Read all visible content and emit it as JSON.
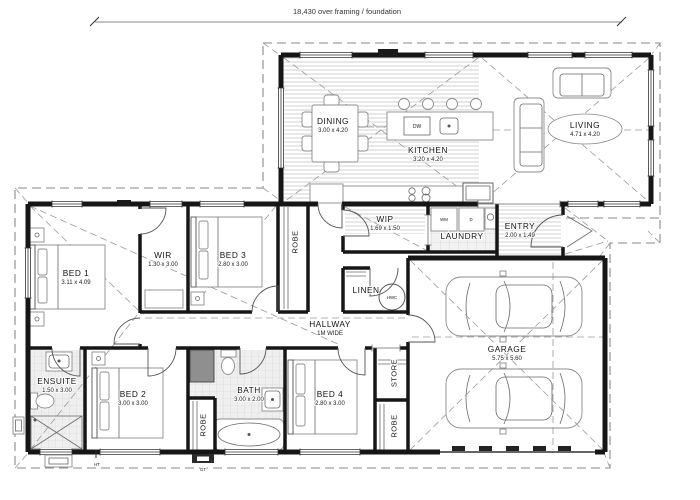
{
  "plan": {
    "dimension_note": "18,430 over framing / foundation",
    "rooms": {
      "dining": {
        "name": "DINING",
        "dims": "3.00 x 4.20"
      },
      "kitchen": {
        "name": "KITCHEN",
        "dims": "3.20 x 4.20"
      },
      "living": {
        "name": "LIVING",
        "dims": "4.71 x 4.20"
      },
      "wip": {
        "name": "WIP",
        "dims": "1.69 x 1.50"
      },
      "laundry": {
        "name": "LAUNDRY"
      },
      "entry": {
        "name": "ENTRY",
        "dims": "2.00 x 1.49"
      },
      "wir": {
        "name": "WIR",
        "dims": "1.30 x 3.00"
      },
      "bed1": {
        "name": "BED 1",
        "dims": "3.11 x 4.09"
      },
      "bed2": {
        "name": "BED 2",
        "dims": "3.00 x 3.00"
      },
      "bed3": {
        "name": "BED 3",
        "dims": "2.80 x 3.00"
      },
      "bed4": {
        "name": "BED 4",
        "dims": "2.80 x 3.00"
      },
      "ensuite": {
        "name": "ENSUITE",
        "dims": "1.50 x 3.00"
      },
      "bath": {
        "name": "BATH",
        "dims": "3.00 x 2.00"
      },
      "hallway": {
        "name": "HALLWAY",
        "dims": "1M WIDE"
      },
      "garage": {
        "name": "GARAGE",
        "dims": "5.75 x 5.60"
      },
      "linen": {
        "name": "LINEN"
      },
      "store": {
        "name": "STORE"
      },
      "robe_bed3": {
        "name": "ROBE"
      },
      "robe_bed2": {
        "name": "ROBE"
      },
      "robe_bed4": {
        "name": "ROBE"
      }
    },
    "labels": {
      "dw": "DW",
      "wm": "WM",
      "dryer": "D",
      "hwc": "HWC",
      "ht": "HT",
      "gt": "GT"
    }
  }
}
